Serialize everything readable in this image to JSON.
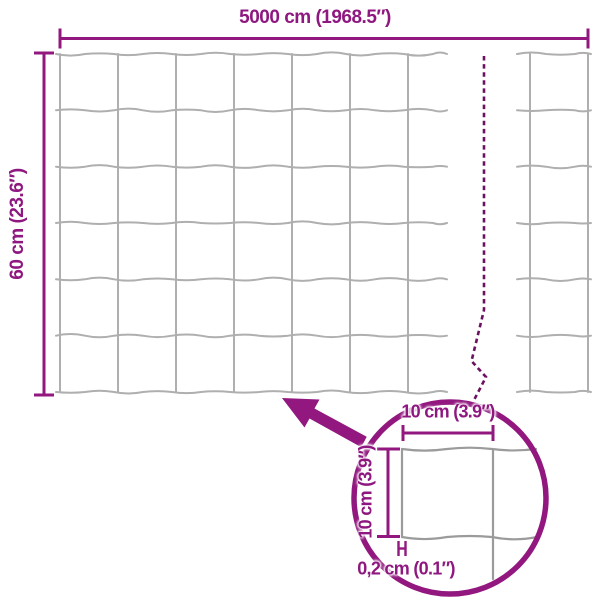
{
  "diagram": {
    "labels": {
      "total_width": "5000 cm (1968.5″)",
      "total_height": "60 cm (23.6″)",
      "mesh_width": "10 cm (3.9″)",
      "mesh_height": "10 cm (3.9″)",
      "wire_thickness": "0,2 cm (0.1″)"
    },
    "colors": {
      "accent": "#92187F",
      "break_dash": "#6B1160",
      "mesh_gray": "#AFAFAF",
      "detail_gray": "#9B9B9B",
      "background": "#FFFFFF"
    },
    "mesh": {
      "cell_rows": 6,
      "cell_size_label": "10 cm (3.9″)",
      "wire_label": "0,2 cm (0.1″)"
    }
  }
}
